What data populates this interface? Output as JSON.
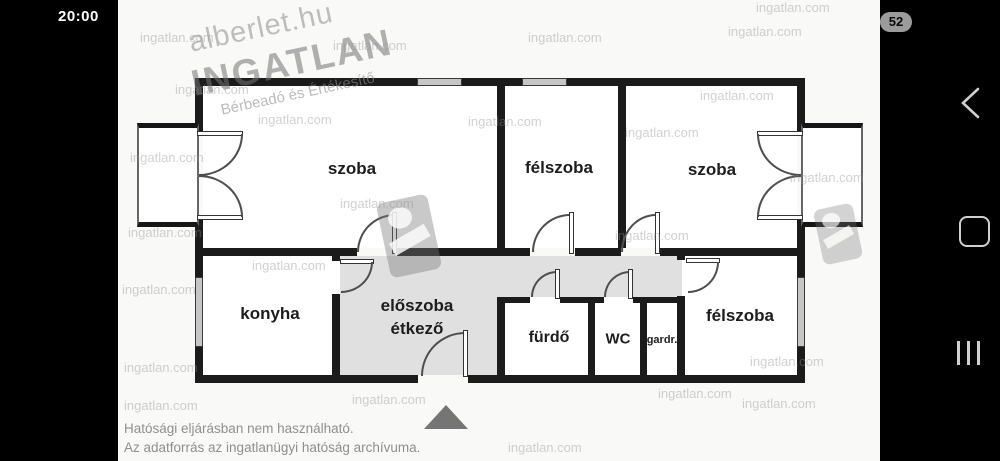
{
  "status_bar": {
    "time": "20:00",
    "battery_percent": "52"
  },
  "navigation": {
    "back_icon": "back-chevron",
    "home_icon": "home-rounded-square",
    "recents_icon": "three-bars"
  },
  "floorplan": {
    "rooms": [
      {
        "id": "room-top-left",
        "label": "szoba"
      },
      {
        "id": "halfroom-top",
        "label": "félszoba"
      },
      {
        "id": "room-top-right",
        "label": "szoba"
      },
      {
        "id": "kitchen",
        "label": "konyha"
      },
      {
        "id": "hallway-dining",
        "label_line1": "előszoba",
        "label_line2": "étkező"
      },
      {
        "id": "bathroom",
        "label": "fürdő"
      },
      {
        "id": "wc",
        "label": "WC"
      },
      {
        "id": "wardrobe",
        "label": "gardr."
      },
      {
        "id": "halfroom-bottom",
        "label": "félszoba"
      }
    ],
    "watermark": {
      "site": "ingatlan.com",
      "brand_top": "alberlet.hu",
      "brand_main": "INGATLAN",
      "brand_sub": "Bérbeadó és Értékesítő"
    },
    "disclaimer_line1": "Hatósági eljárásban nem használható.",
    "disclaimer_line2": "Az adatforrás az ingatlanügyi hatóság archívuma.",
    "colors": {
      "wall": "#1b1b1b",
      "hallway_fill": "#e0e0e0",
      "watermark_gray": "#9a9a9a"
    }
  }
}
